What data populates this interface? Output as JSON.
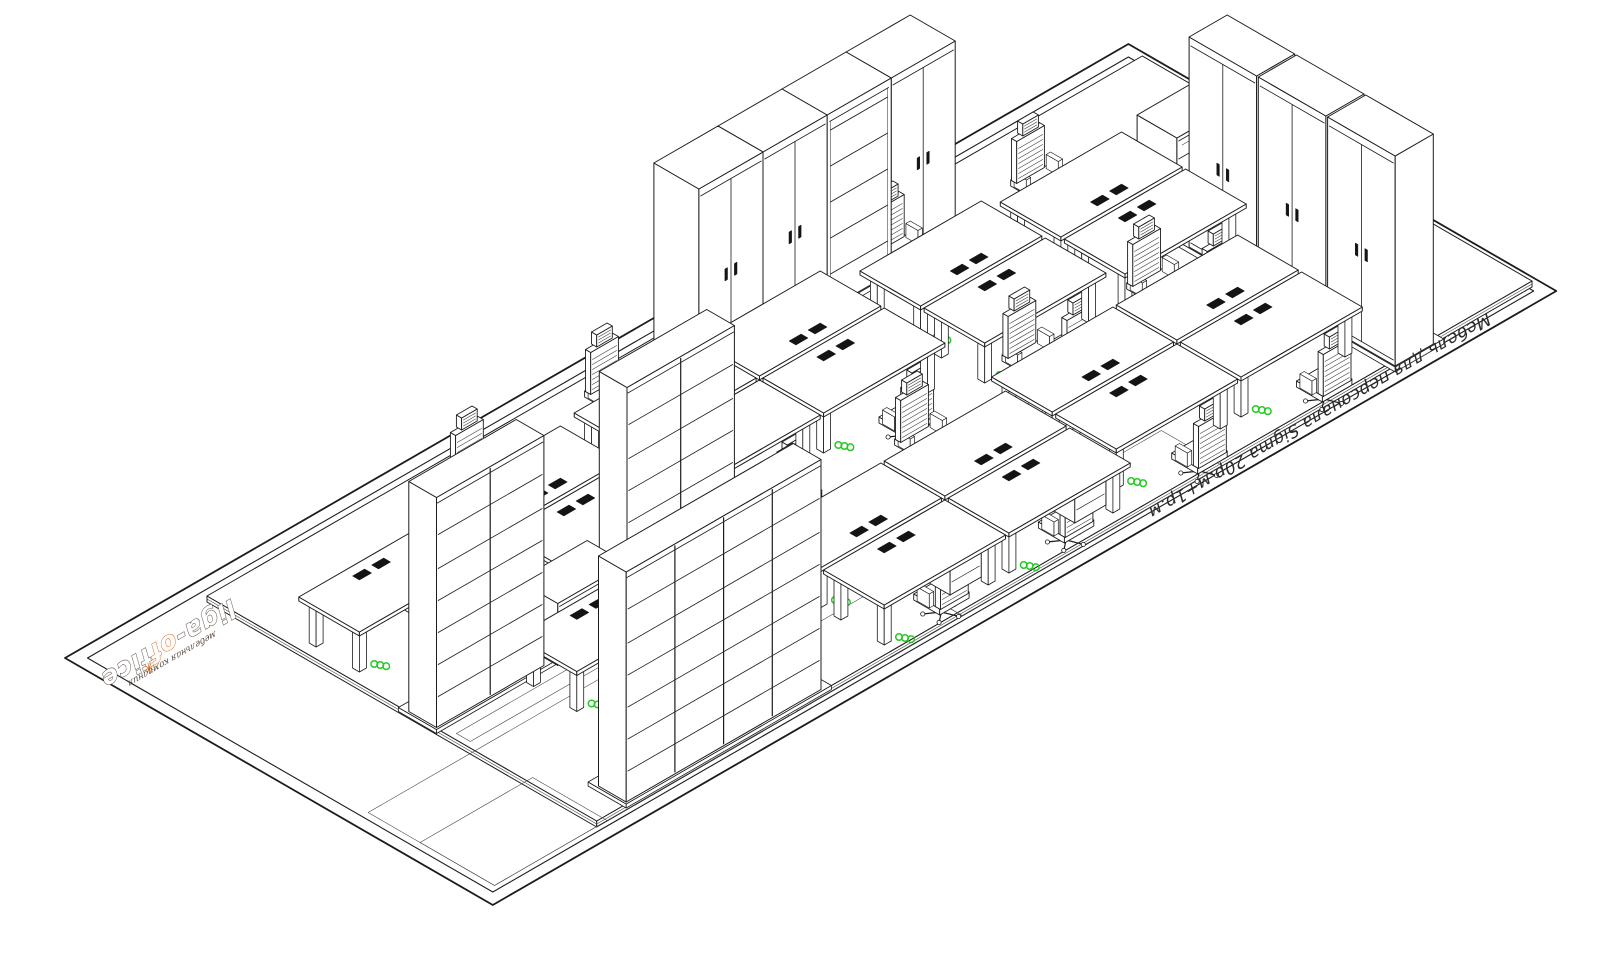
{
  "caption": {
    "text": "Мебель для персонала Sigma 20р.м+1р.м"
  },
  "logo": {
    "name_part1": "liga-",
    "name_accent": "of",
    "name_part2": "fice",
    "tagline": "мебельная компания",
    "mark": "✳"
  },
  "colors": {
    "line": "#1c1c1c",
    "thin": "#474747",
    "paper": "#ffffff",
    "green": "#25c825",
    "orange": "#d96a1e",
    "dark": "#141414"
  },
  "projection": {
    "origin_x": 65,
    "origin_y": 658,
    "cos": 0.866,
    "sin": 0.5
  },
  "sheet": {
    "length": 1228,
    "depth": 494,
    "inset": 13
  },
  "platform": {
    "a": 138,
    "b": 26,
    "du": 1080,
    "dv": 450,
    "h": 6
  },
  "zones": [
    [
      20,
      330,
      340,
      146
    ],
    [
      20,
      390,
      130,
      86
    ],
    [
      370,
      400,
      190,
      76
    ],
    [
      150,
      302,
      710,
      16
    ],
    [
      560,
      406,
      300,
      70
    ]
  ],
  "skirts": [
    [
      634,
      34,
      308,
      64,
      5
    ],
    [
      1054,
      232,
      56,
      250,
      5
    ],
    [
      139,
      246,
      356,
      44,
      4
    ],
    [
      174,
      430,
      237,
      44,
      4
    ]
  ],
  "cabinets": [
    {
      "type": "wardrobe",
      "a": 640,
      "b": 40,
      "du": 74,
      "dv": 52,
      "h": 195,
      "front": "v"
    },
    {
      "type": "wardrobe",
      "a": 714,
      "b": 40,
      "du": 74,
      "dv": 52,
      "h": 195,
      "front": "v"
    },
    {
      "type": "bookcase",
      "a": 788,
      "b": 40,
      "du": 74,
      "dv": 52,
      "h": 195,
      "front": "v"
    },
    {
      "type": "wardrobe",
      "a": 862,
      "b": 40,
      "du": 74,
      "dv": 52,
      "h": 195,
      "front": "v"
    },
    {
      "type": "lowcab",
      "a": 1100,
      "b": 138,
      "du": 80,
      "dv": 46,
      "h": 62,
      "front": "v"
    },
    {
      "type": "wardrobe",
      "a": 1060,
      "b": 238,
      "du": 44,
      "dv": 78,
      "h": 210,
      "front": "u"
    },
    {
      "type": "wardrobe",
      "a": 1060,
      "b": 318,
      "du": 44,
      "dv": 78,
      "h": 210,
      "front": "u"
    },
    {
      "type": "wardrobe",
      "a": 1060,
      "b": 398,
      "du": 44,
      "dv": 78,
      "h": 210,
      "front": "u"
    },
    {
      "type": "lowcab",
      "a": 277,
      "b": 246,
      "du": 80,
      "dv": 46,
      "h": 62,
      "front": "v"
    },
    {
      "type": "rack",
      "a": 145,
      "b": 252,
      "du": 124,
      "dv": 32,
      "h": 230,
      "units": 2,
      "front": "v"
    },
    {
      "type": "rack",
      "a": 365,
      "b": 252,
      "du": 124,
      "dv": 32,
      "h": 230,
      "units": 2,
      "front": "v"
    },
    {
      "type": "rack",
      "a": 180,
      "b": 436,
      "du": 225,
      "dv": 32,
      "h": 230,
      "units": 4,
      "front": "v"
    }
  ],
  "desks": [
    {
      "a": 800,
      "b": 118,
      "spine": "+",
      "ped": false
    },
    {
      "a": 800,
      "b": 192,
      "spine": "-",
      "ped": false
    },
    {
      "a": 950,
      "b": 130,
      "spine": "+",
      "ped": false
    },
    {
      "a": 950,
      "b": 204,
      "spine": "-",
      "ped": false
    },
    {
      "a": 493,
      "b": 95,
      "spine": "+",
      "ped": false
    },
    {
      "a": 637,
      "b": 95,
      "spine": "+",
      "ped": false
    },
    {
      "a": 493,
      "b": 169,
      "spine": "-",
      "ped": false
    },
    {
      "a": 637,
      "b": 169,
      "spine": "-",
      "ped": false
    },
    {
      "a": 770,
      "b": 300,
      "spine": "+",
      "ped": false
    },
    {
      "a": 914,
      "b": 300,
      "spine": "+",
      "ped": false
    },
    {
      "a": 770,
      "b": 374,
      "spine": "-",
      "ped": false
    },
    {
      "a": 914,
      "b": 374,
      "spine": "-",
      "ped": false
    },
    {
      "a": 480,
      "b": 322,
      "spine": "+",
      "ped": false
    },
    {
      "a": 624,
      "b": 322,
      "spine": "+",
      "ped": false
    },
    {
      "a": 480,
      "b": 396,
      "spine": "-",
      "ped": true
    },
    {
      "a": 624,
      "b": 396,
      "spine": "-",
      "ped": true
    },
    {
      "a": 332,
      "b": 100,
      "spine": "+",
      "ped": true
    },
    {
      "a": 332,
      "b": 174,
      "spine": "-",
      "ped": true
    },
    {
      "a": 236,
      "b": 285,
      "spine": "-",
      "ped": true
    },
    {
      "a": 150,
      "b": 120,
      "spine": "-",
      "ped": true
    }
  ],
  "desk_size": {
    "du": 140,
    "dv": 70,
    "h": 46
  },
  "desk_accessories": {
    "grommets_per_desk": 2,
    "cable_coil": true
  },
  "chairs": [
    [
      870,
      92,
      "-"
    ],
    [
      870,
      288,
      "+"
    ],
    [
      1020,
      104,
      "-"
    ],
    [
      1020,
      300,
      "+"
    ],
    [
      563,
      69,
      "-"
    ],
    [
      707,
      69,
      "-"
    ],
    [
      563,
      265,
      "+"
    ],
    [
      707,
      265,
      "+"
    ],
    [
      840,
      274,
      "-"
    ],
    [
      984,
      274,
      "-"
    ],
    [
      840,
      470,
      "+"
    ],
    [
      984,
      470,
      "+"
    ],
    [
      550,
      296,
      "-"
    ],
    [
      694,
      296,
      "-"
    ],
    [
      550,
      462,
      "+"
    ],
    [
      694,
      462,
      "+"
    ],
    [
      402,
      74,
      "-"
    ],
    [
      402,
      240,
      "+"
    ],
    [
      306,
      382,
      "+"
    ],
    [
      220,
      214,
      "+"
    ]
  ]
}
